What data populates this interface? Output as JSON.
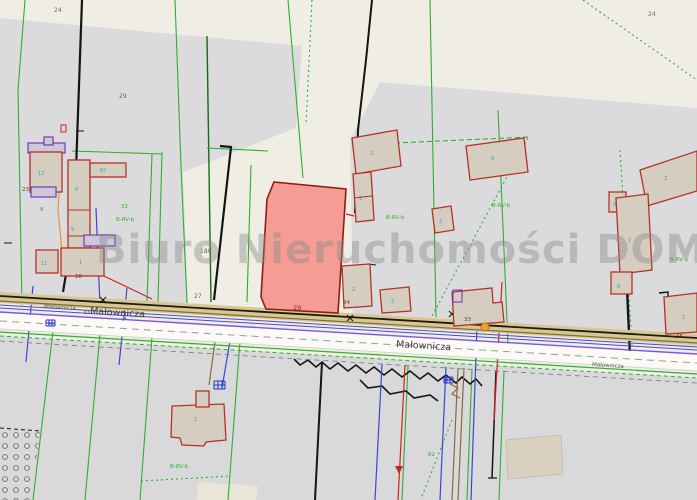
{
  "map": {
    "watermark": "Biuro Nieruchomości DOM",
    "street": {
      "name": "Małownicza",
      "name_small": "Małownicza"
    },
    "parcel_numbers": {
      "p24a": "24",
      "p29a": "29",
      "p24b": "24",
      "p27": "27",
      "p32": "32",
      "p8": "8",
      "p180": "180",
      "p62": "62"
    },
    "land_use_label": "B-RV-b",
    "address_numbers": {
      "a23": "23",
      "a28": "28",
      "a29": "29",
      "a34": "34",
      "a33a": "33",
      "a33b": "33",
      "a35": "35"
    },
    "building_labels": {
      "b1": "12",
      "arm": "87",
      "s1": "8",
      "s2": "9",
      "sq": "11",
      "bb": "1",
      "t1": "2",
      "t2": "8",
      "t3": "2",
      "c1": "1",
      "c2": "2",
      "c3": "2",
      "r1": "2",
      "r2": "8",
      "r3": "2",
      "r4": "8",
      "r5": "1",
      "bl": "1"
    },
    "colors": {
      "background_beige": "#f0eee4",
      "built_area_gray": "#dbdbdd",
      "highlight_parcel_fill": "#f59c94",
      "highlight_parcel_stroke": "#8f1d12",
      "building_fill": "#d5cdc0",
      "building_stroke": "#b43226",
      "boundary_green": "#2fae2f",
      "utility_blue": "#3a46cf",
      "watermark_gray": "#8a8a8a"
    }
  }
}
